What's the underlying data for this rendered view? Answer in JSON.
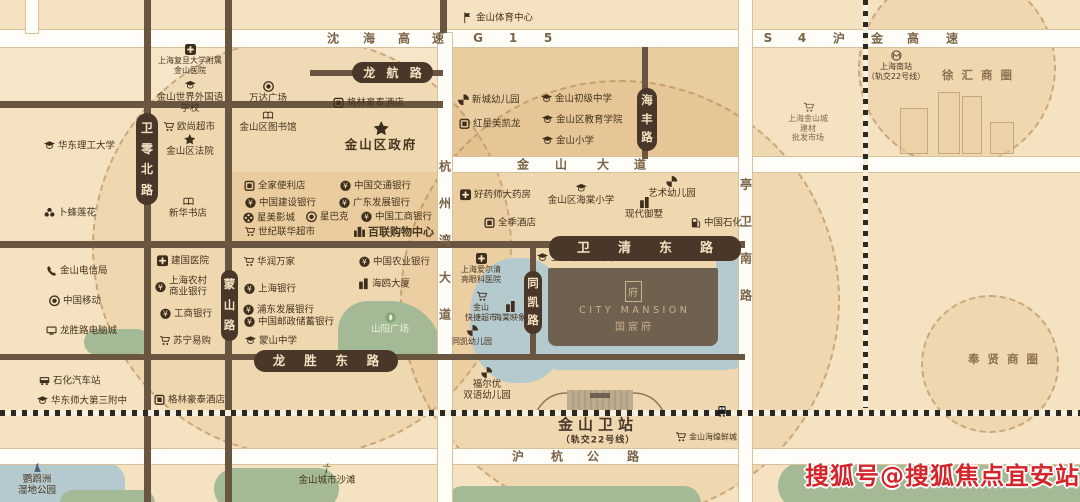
{
  "watermark": {
    "text": "搜狐号@搜狐焦点宜安站",
    "color": "#d4252a"
  },
  "project": {
    "emblem": "府",
    "name_en": "CITY MANSION",
    "name_cn": "国宸府"
  },
  "station": {
    "name": "金山卫站",
    "sub": "（轨交22号线）",
    "x": 598,
    "y": 424,
    "sub_y": 439
  },
  "districts": [
    {
      "t": "徐 汇 商 圈",
      "x": 978,
      "y": 75
    },
    {
      "t": "奉 贤 商 圈",
      "x": 1004,
      "y": 359
    }
  ],
  "blocks": [
    {
      "x": 443,
      "y": 47,
      "w": 296,
      "h": 110,
      "c": "#e9cc9f"
    },
    {
      "x": 0,
      "y": 47,
      "w": 440,
      "h": 54,
      "c": "#f6e5c6"
    },
    {
      "x": 228,
      "y": 172,
      "w": 212,
      "h": 69,
      "c": "#eed4a9"
    }
  ],
  "circles": [
    {
      "cx": 300,
      "cy": 245,
      "r": 208
    },
    {
      "cx": 618,
      "cy": 298,
      "r": 218
    },
    {
      "cx": 955,
      "cy": 66,
      "r": 97
    },
    {
      "cx": 988,
      "cy": 362,
      "r": 67
    }
  ],
  "waters": [
    {
      "x": -25,
      "y": 452,
      "w": 150,
      "h": 70,
      "r": "40%"
    },
    {
      "x": 470,
      "y": 258,
      "w": 98,
      "h": 125,
      "r": "45%"
    },
    {
      "x": 716,
      "y": 247,
      "w": 23,
      "h": 122,
      "r": "4px"
    },
    {
      "x": 548,
      "y": 334,
      "w": 192,
      "h": 36,
      "r": "0 0 14px 10px"
    }
  ],
  "greens": [
    {
      "x": 338,
      "y": 301,
      "w": 104,
      "h": 53,
      "r": "30px 52px 0 0"
    },
    {
      "x": 84,
      "y": 329,
      "w": 66,
      "h": 26,
      "r": "13px"
    },
    {
      "x": 214,
      "y": 468,
      "w": 125,
      "h": 42,
      "r": "24px"
    },
    {
      "x": 446,
      "y": 486,
      "w": 255,
      "h": 34,
      "r": "17px"
    },
    {
      "x": 778,
      "y": 462,
      "w": 320,
      "h": 48,
      "r": "24px"
    },
    {
      "x": 60,
      "y": 490,
      "w": 95,
      "h": 26,
      "r": "13px"
    }
  ],
  "buildings": [
    {
      "x": 900,
      "y": 108,
      "w": 26,
      "h": 44
    },
    {
      "x": 938,
      "y": 92,
      "w": 20,
      "h": 60
    },
    {
      "x": 962,
      "y": 96,
      "w": 18,
      "h": 56
    },
    {
      "x": 990,
      "y": 122,
      "w": 22,
      "h": 30
    }
  ],
  "roads": {
    "h": [
      {
        "x": 0,
        "y": 30,
        "w": 1080,
        "h": 17,
        "t": "w"
      },
      {
        "x": 310,
        "y": 70,
        "w": 133,
        "h": 6,
        "t": "b"
      },
      {
        "x": 0,
        "y": 101,
        "w": 443,
        "h": 7,
        "t": "b"
      },
      {
        "x": 443,
        "y": 157,
        "w": 637,
        "h": 15,
        "t": "w"
      },
      {
        "x": 0,
        "y": 241,
        "w": 745,
        "h": 7,
        "t": "b"
      },
      {
        "x": 0,
        "y": 354,
        "w": 745,
        "h": 6,
        "t": "b"
      },
      {
        "x": 0,
        "y": 449,
        "w": 1080,
        "h": 15,
        "t": "w"
      }
    ],
    "v": [
      {
        "x": 26,
        "y": 0,
        "w": 12,
        "h": 33,
        "t": "w"
      },
      {
        "x": 144,
        "y": 0,
        "w": 7,
        "h": 502,
        "t": "b"
      },
      {
        "x": 225,
        "y": 0,
        "w": 7,
        "h": 502,
        "t": "b"
      },
      {
        "x": 440,
        "y": 0,
        "w": 7,
        "h": 33,
        "t": "b"
      },
      {
        "x": 438,
        "y": 33,
        "w": 14,
        "h": 469,
        "t": "w"
      },
      {
        "x": 530,
        "y": 247,
        "w": 6,
        "h": 112,
        "t": "b"
      },
      {
        "x": 642,
        "y": 47,
        "w": 6,
        "h": 112,
        "t": "b"
      },
      {
        "x": 739,
        "y": 0,
        "w": 13,
        "h": 502,
        "t": "w"
      }
    ]
  },
  "railways": [
    {
      "x": 863,
      "y": 0,
      "w": 5,
      "h": 408,
      "dir": "v"
    },
    {
      "x": 0,
      "y": 410,
      "w": 1080,
      "h": 6,
      "dir": "h"
    }
  ],
  "road_chars": [
    {
      "t": "沈",
      "x": 333,
      "y": 38
    },
    {
      "t": "海",
      "x": 369,
      "y": 38
    },
    {
      "t": "高",
      "x": 404,
      "y": 38
    },
    {
      "t": "速",
      "x": 438,
      "y": 38
    },
    {
      "t": "G",
      "x": 478,
      "y": 38
    },
    {
      "t": "1",
      "x": 513,
      "y": 38
    },
    {
      "t": "5",
      "x": 548,
      "y": 38
    },
    {
      "t": "S",
      "x": 768,
      "y": 38
    },
    {
      "t": "4",
      "x": 802,
      "y": 38
    },
    {
      "t": "沪",
      "x": 839,
      "y": 38
    },
    {
      "t": "金",
      "x": 877,
      "y": 38
    },
    {
      "t": "高",
      "x": 913,
      "y": 38
    },
    {
      "t": "速",
      "x": 952,
      "y": 38
    },
    {
      "t": "金",
      "x": 523,
      "y": 164
    },
    {
      "t": "山",
      "x": 561,
      "y": 164
    },
    {
      "t": "大",
      "x": 603,
      "y": 164
    },
    {
      "t": "道",
      "x": 640,
      "y": 164
    },
    {
      "t": "沪",
      "x": 518,
      "y": 456
    },
    {
      "t": "杭",
      "x": 557,
      "y": 456
    },
    {
      "t": "公",
      "x": 593,
      "y": 456
    },
    {
      "t": "路",
      "x": 633,
      "y": 456
    },
    {
      "t": "杭",
      "x": 445,
      "y": 166
    },
    {
      "t": "州",
      "x": 445,
      "y": 203
    },
    {
      "t": "湾",
      "x": 445,
      "y": 240
    },
    {
      "t": "大",
      "x": 445,
      "y": 277
    },
    {
      "t": "道",
      "x": 445,
      "y": 314
    },
    {
      "t": "亭",
      "x": 746,
      "y": 184
    },
    {
      "t": "卫",
      "x": 746,
      "y": 221
    },
    {
      "t": "南",
      "x": 746,
      "y": 258
    },
    {
      "t": "路",
      "x": 746,
      "y": 295
    }
  ],
  "pills": [
    {
      "t": "龙航路",
      "x": 352,
      "y": 62,
      "w": 81,
      "h": 21,
      "v": 0,
      "fs": 12
    },
    {
      "t": "卫清东路",
      "x": 549,
      "y": 236,
      "w": 192,
      "h": 25,
      "v": 0,
      "fs": 13
    },
    {
      "t": "龙胜东路",
      "x": 254,
      "y": 350,
      "w": 144,
      "h": 22,
      "v": 0,
      "fs": 12.5
    },
    {
      "t": "卫零北路",
      "x": 136,
      "y": 113,
      "w": 22,
      "h": 92,
      "v": 1,
      "fs": 12
    },
    {
      "t": "蒙山路",
      "x": 221,
      "y": 270,
      "w": 17,
      "h": 71,
      "v": 1,
      "fs": 11.5
    },
    {
      "t": "海丰路",
      "x": 637,
      "y": 88,
      "w": 20,
      "h": 63,
      "v": 1,
      "fs": 11.5
    },
    {
      "t": "同凯路",
      "x": 524,
      "y": 271,
      "w": 18,
      "h": 63,
      "v": 1,
      "fs": 11.5
    }
  ],
  "pois": [
    {
      "id": "fudan-jinshan-hospital",
      "i": "cross",
      "l": "c",
      "x": 190,
      "y": 44,
      "t": [
        "上海复旦大学附属",
        "金山医院"
      ],
      "c": "tiny"
    },
    {
      "id": "world-foreign-language-school",
      "i": "school",
      "l": "c",
      "x": 190,
      "y": 80,
      "t": [
        "金山世界外国语",
        "学校"
      ]
    },
    {
      "id": "wanda-plaza",
      "i": "coffee",
      "l": "c",
      "x": 268,
      "y": 81,
      "t": [
        "万达广场"
      ]
    },
    {
      "id": "jinshan-library",
      "i": "book",
      "l": "c",
      "x": 268,
      "y": 110,
      "t": [
        "金山区图书馆"
      ]
    },
    {
      "id": "greentree-hotel-north",
      "i": "shop",
      "l": "r",
      "x": 333,
      "y": 103,
      "t": [
        "格林豪泰酒店"
      ]
    },
    {
      "id": "auchan-supermarket",
      "i": "cart",
      "l": "r",
      "x": 163,
      "y": 127,
      "t": [
        "欧尚超市"
      ]
    },
    {
      "id": "ecust-university",
      "i": "school",
      "l": "r",
      "x": 44,
      "y": 146,
      "t": [
        "华东理工大学"
      ]
    },
    {
      "id": "jinshan-court",
      "i": "star",
      "l": "c",
      "x": 190,
      "y": 134,
      "t": [
        "金山区法院"
      ]
    },
    {
      "id": "jinshan-government",
      "i": "star",
      "l": "c",
      "x": 381,
      "y": 121,
      "t": [
        "金山区政府"
      ],
      "c": "big"
    },
    {
      "id": "lotus-supermarket",
      "i": "flower",
      "l": "r",
      "x": 44,
      "y": 213,
      "t": [
        "卜蜂莲花"
      ]
    },
    {
      "id": "xinhua-bookstore",
      "i": "book",
      "l": "c",
      "x": 188,
      "y": 196,
      "t": [
        "新华书店"
      ]
    },
    {
      "id": "jinshan-telecom",
      "i": "phone",
      "l": "r",
      "x": 46,
      "y": 271,
      "t": [
        "金山电信局"
      ]
    },
    {
      "id": "china-mobile",
      "i": "coffee",
      "l": "r",
      "x": 49,
      "y": 301,
      "t": [
        "中国移动"
      ]
    },
    {
      "id": "longsheng-computer-city",
      "i": "pc",
      "l": "r",
      "x": 46,
      "y": 331,
      "t": [
        "龙胜路电脑城"
      ]
    },
    {
      "id": "jianguo-hospital",
      "i": "cross",
      "l": "r",
      "x": 157,
      "y": 261,
      "t": [
        "建国医院"
      ]
    },
    {
      "id": "rural-commercial-bank",
      "i": "bank",
      "l": "r",
      "x": 155,
      "y": 287,
      "t": [
        "上海农村",
        "商业银行"
      ]
    },
    {
      "id": "icbc-west",
      "i": "bank",
      "l": "r",
      "x": 160,
      "y": 314,
      "t": [
        "工商银行"
      ]
    },
    {
      "id": "suning",
      "i": "cart",
      "l": "r",
      "x": 159,
      "y": 341,
      "t": [
        "苏宁易购"
      ]
    },
    {
      "id": "shihua-bus-station",
      "i": "bus",
      "l": "r",
      "x": 39,
      "y": 381,
      "t": [
        "石化汽车站"
      ]
    },
    {
      "id": "hdsd-no3-middle-school",
      "i": "school",
      "l": "r",
      "x": 37,
      "y": 401,
      "t": [
        "华东师大第三附中"
      ]
    },
    {
      "id": "greentree-hotel-south",
      "i": "shop",
      "l": "r",
      "x": 154,
      "y": 400,
      "t": [
        "格林豪泰酒店"
      ]
    },
    {
      "id": "mengshan-middle-school",
      "i": "school",
      "l": "r",
      "x": 245,
      "y": 341,
      "t": [
        "蒙山中学"
      ]
    },
    {
      "id": "parrot-wetland-park",
      "i": "bird",
      "l": "c",
      "x": 37,
      "y": 462,
      "t": [
        "鹦鹉洲",
        "湿地公园"
      ]
    },
    {
      "id": "jinshan-city-beach",
      "i": "palm",
      "l": "c",
      "x": 327,
      "y": 463,
      "t": [
        "金山城市沙滩"
      ]
    },
    {
      "id": "family-mart",
      "i": "shop",
      "l": "r",
      "x": 244,
      "y": 186,
      "t": [
        "全家便利店"
      ]
    },
    {
      "id": "ccb-bank",
      "i": "bank",
      "l": "r",
      "x": 245,
      "y": 203,
      "t": [
        "中国建设银行"
      ]
    },
    {
      "id": "stellar-cinema",
      "i": "film",
      "l": "r",
      "x": 243,
      "y": 218,
      "t": [
        "星美影城"
      ]
    },
    {
      "id": "starbucks",
      "i": "coffee",
      "l": "r",
      "x": 306,
      "y": 217,
      "t": [
        "星巴克"
      ]
    },
    {
      "id": "lianhua-supermarket",
      "i": "cart",
      "l": "r",
      "x": 244,
      "y": 232,
      "t": [
        "世纪联华超市"
      ]
    },
    {
      "id": "bocom-bank",
      "i": "bank",
      "l": "r",
      "x": 340,
      "y": 186,
      "t": [
        "中国交通银行"
      ]
    },
    {
      "id": "gdb-bank",
      "i": "bank",
      "l": "r",
      "x": 339,
      "y": 203,
      "t": [
        "广东发展银行"
      ]
    },
    {
      "id": "icbc-bank",
      "i": "bank",
      "l": "r",
      "x": 361,
      "y": 217,
      "t": [
        "中国工商银行"
      ]
    },
    {
      "id": "bailian-shopping-center",
      "i": "towers",
      "l": "r",
      "x": 354,
      "y": 232,
      "t": [
        "百联购物中心"
      ],
      "c": "bold"
    },
    {
      "id": "vanguard",
      "i": "cart",
      "l": "r",
      "x": 243,
      "y": 262,
      "t": [
        "华润万家"
      ]
    },
    {
      "id": "bank-of-shanghai",
      "i": "bank",
      "l": "r",
      "x": 244,
      "y": 289,
      "t": [
        "上海银行"
      ]
    },
    {
      "id": "spd-bank",
      "i": "bank",
      "l": "r",
      "x": 243,
      "y": 310,
      "t": [
        "浦东发展银行"
      ]
    },
    {
      "id": "psbc-bank",
      "i": "bank",
      "l": "r",
      "x": 244,
      "y": 322,
      "t": [
        "中国邮政储蓄银行"
      ]
    },
    {
      "id": "abc-bank",
      "i": "bank",
      "l": "r",
      "x": 359,
      "y": 262,
      "t": [
        "中国农业银行"
      ]
    },
    {
      "id": "seagull-tower",
      "i": "building",
      "l": "r",
      "x": 358,
      "y": 284,
      "t": [
        "海鸥大厦"
      ]
    },
    {
      "id": "shanyang-plaza",
      "i": "leaf",
      "l": "c",
      "x": 390,
      "y": 312,
      "t": [
        "山阳广场"
      ],
      "c": "on-green"
    },
    {
      "id": "jinshan-sports-center",
      "i": "flag",
      "l": "r",
      "x": 462,
      "y": 18,
      "t": [
        "金山体育中心"
      ]
    },
    {
      "id": "xincheng-kindergarten",
      "i": "windmill",
      "l": "r",
      "x": 458,
      "y": 100,
      "t": [
        "新城幼儿园"
      ]
    },
    {
      "id": "redstar-macalline",
      "i": "shop",
      "l": "r",
      "x": 459,
      "y": 124,
      "t": [
        "红星美凯龙"
      ]
    },
    {
      "id": "jinshan-junior-middle-school",
      "i": "school",
      "l": "r",
      "x": 541,
      "y": 99,
      "t": [
        "金山初级中学"
      ]
    },
    {
      "id": "jinshan-education-institute",
      "i": "school",
      "l": "r",
      "x": 542,
      "y": 120,
      "t": [
        "金山区教育学院"
      ]
    },
    {
      "id": "jinshan-primary-school",
      "i": "school",
      "l": "r",
      "x": 542,
      "y": 141,
      "t": [
        "金山小学"
      ]
    },
    {
      "id": "haoyaoshi-pharmacy",
      "i": "cross",
      "l": "r",
      "x": 460,
      "y": 195,
      "t": [
        "好药师大药房"
      ]
    },
    {
      "id": "haitang-primary-school",
      "i": "school",
      "l": "c",
      "x": 581,
      "y": 183,
      "t": [
        "金山区海棠小学"
      ]
    },
    {
      "id": "art-kindergarten",
      "i": "windmill",
      "l": "c",
      "x": 672,
      "y": 176,
      "t": [
        "艺术幼儿园"
      ]
    },
    {
      "id": "ji-hotel",
      "i": "shop",
      "l": "r",
      "x": 484,
      "y": 223,
      "t": [
        "全季酒店"
      ]
    },
    {
      "id": "modern-villa",
      "i": "building",
      "l": "c",
      "x": 644,
      "y": 197,
      "t": [
        "现代御墅"
      ]
    },
    {
      "id": "sinopec",
      "i": "gas",
      "l": "r",
      "x": 690,
      "y": 223,
      "t": [
        "中国石化"
      ]
    },
    {
      "id": "tongkai-middle-school",
      "i": "school",
      "l": "r",
      "x": 537,
      "y": 258,
      "t": [
        "上海市同凯中学"
      ]
    },
    {
      "id": "aier-eye-hospital",
      "i": "cross",
      "l": "c",
      "x": 481,
      "y": 253,
      "t": [
        "上海爱尔清",
        "亮眼科医院"
      ],
      "c": "tiny"
    },
    {
      "id": "kuaijie-supermarket",
      "i": "cart",
      "l": "c",
      "x": 481,
      "y": 291,
      "t": [
        "金山",
        "快捷超市"
      ],
      "c": "tiny"
    },
    {
      "id": "haitang-yingxiang",
      "i": "building",
      "l": "c",
      "x": 510,
      "y": 301,
      "t": [
        "海棠映象"
      ],
      "c": "tiny"
    },
    {
      "id": "tongkai-kindergarten",
      "i": "windmill",
      "l": "c",
      "x": 472,
      "y": 325,
      "t": [
        "同凯幼儿园"
      ],
      "c": "tiny"
    },
    {
      "id": "fueryou-kindergarten",
      "i": "windmill",
      "l": "c",
      "x": 487,
      "y": 367,
      "t": [
        "福尔优",
        "双语幼儿园"
      ]
    },
    {
      "id": "haihuang-market",
      "i": "cart",
      "l": "r",
      "x": 675,
      "y": 437,
      "t": [
        "金山海煌鲜城"
      ],
      "c": "tiny"
    },
    {
      "id": "shanghai-south-station",
      "i": "metro",
      "l": "c",
      "x": 896,
      "y": 50,
      "t": [
        "上海南站",
        "（轨交22号线）"
      ],
      "c": "tiny"
    },
    {
      "id": "jiancai-market",
      "i": "cart",
      "l": "c",
      "x": 808,
      "y": 102,
      "t": [
        "上海金山城",
        "建材",
        "批发市场"
      ],
      "c": "tiny faded"
    },
    {
      "id": "train-marker",
      "i": "train",
      "l": "c",
      "x": 722,
      "y": 406,
      "t": []
    }
  ]
}
